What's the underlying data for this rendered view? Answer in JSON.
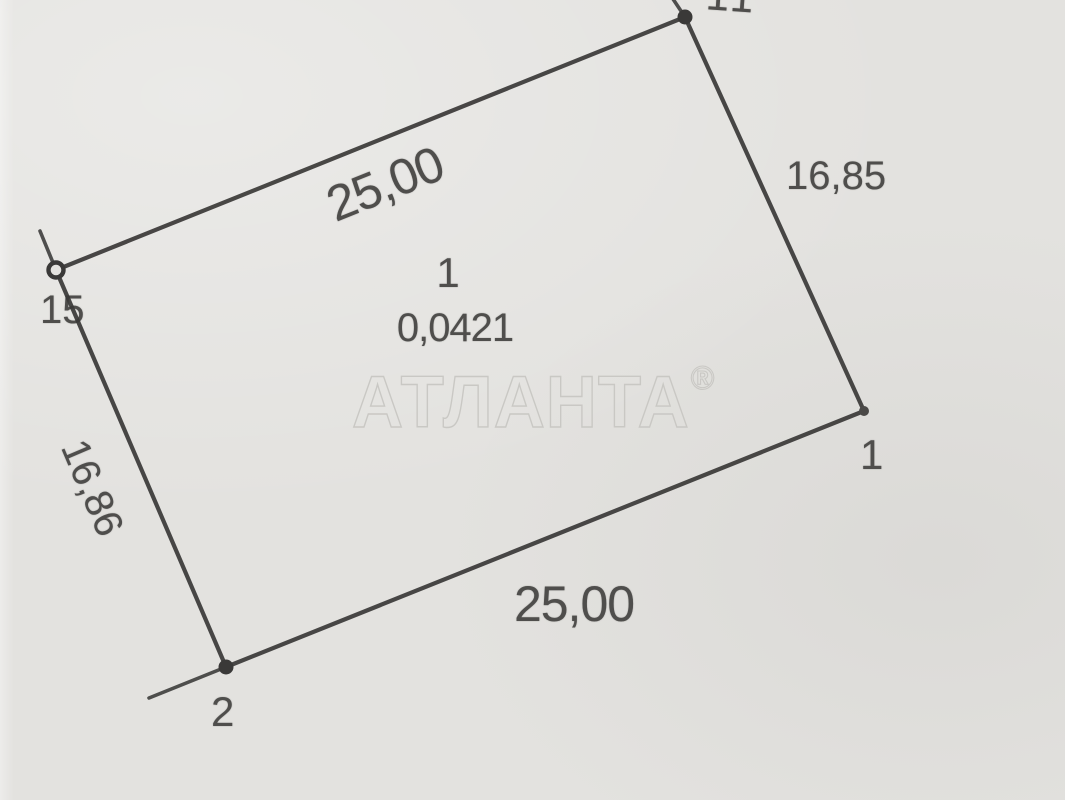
{
  "watermark": {
    "text": "АТЛАНТА",
    "registered": "®"
  },
  "parcel": {
    "number": "1",
    "area": "0,0421",
    "dimensions": {
      "top": "25,00",
      "right": "16,85",
      "bottom": "25,00",
      "left": "16,86"
    },
    "vertices": [
      {
        "label": "15",
        "x": 56,
        "y": 270,
        "marker": "open-circle",
        "tail_to": [
          40,
          231
        ]
      },
      {
        "label": "11",
        "x": 685,
        "y": 17,
        "marker": "filled-dot",
        "tail_to": [
          671,
          -4
        ]
      },
      {
        "label": "1",
        "x": 864,
        "y": 411,
        "marker": "small-dot",
        "tail_to": null
      },
      {
        "label": "2",
        "x": 226,
        "y": 667,
        "marker": "filled-dot",
        "tail_to": [
          149,
          698
        ]
      }
    ]
  },
  "colors": {
    "background": "#e3e2df",
    "line": "#3a3938",
    "text": "#4f4e4c",
    "watermark_outline": "#c9c8c4"
  }
}
